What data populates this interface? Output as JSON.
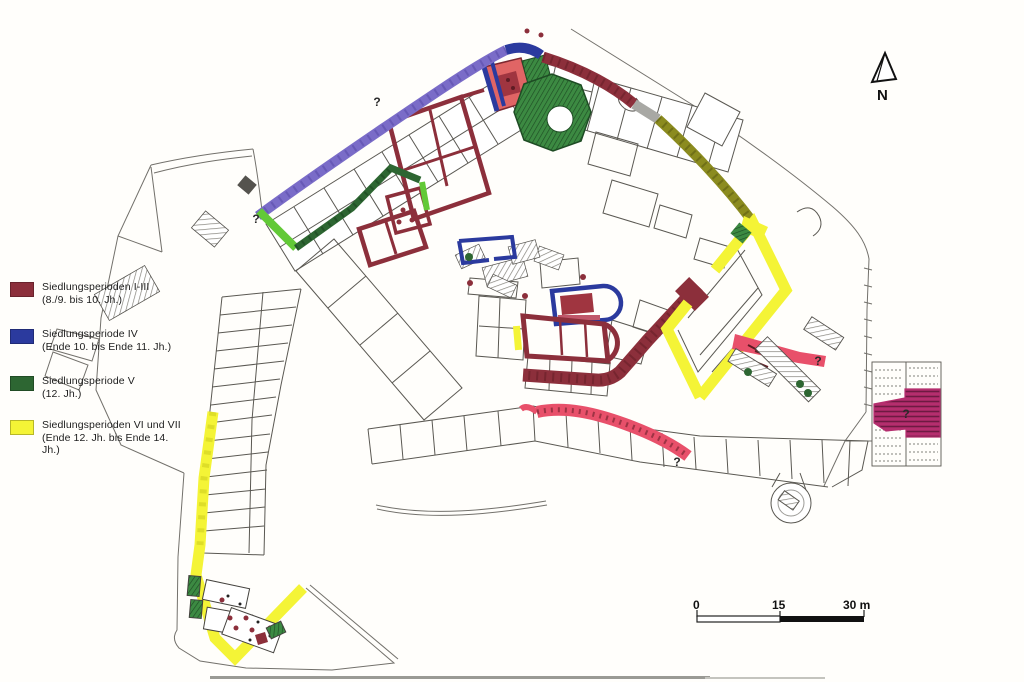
{
  "legend": {
    "items": [
      {
        "label": "Siedlungsperioden I-III",
        "sublabel": "(8./9. bis 10. Jh.)",
        "color": "#8c2f3b"
      },
      {
        "label": "Siedlungsperiode IV",
        "sublabel": "(Ende 10. bis Ende 11. Jh.)",
        "color": "#2b3a9e"
      },
      {
        "label": "Siedlungsperiode V",
        "sublabel": "(12. Jh.)",
        "color": "#2d6632"
      },
      {
        "label": "Siedlungsperioden VI und VII",
        "sublabel": "(Ende 12. Jh. bis Ende 14. Jh.)",
        "color": "#f4f436"
      }
    ]
  },
  "north_arrow": {
    "label": "N"
  },
  "scale_bar": {
    "labels": [
      "0",
      "15",
      "30 m"
    ]
  },
  "map": {
    "question_marks": [
      {
        "label": "?"
      },
      {
        "label": "?"
      },
      {
        "label": "?"
      },
      {
        "label": "?"
      },
      {
        "label": "?"
      }
    ],
    "colors": {
      "period_1_3": "#8c2f3b",
      "period_1_3_dark": "#5f1c24",
      "period_4": "#2b3a9e",
      "period_4_light": "#7a6cc8",
      "period_5": "#2d6632",
      "period_5_light": "#62c937",
      "period_6_7": "#f4f436",
      "olive_wall": "#8b8b1f",
      "pink_wall": "#e8506a",
      "magenta_area": "#b52e6e",
      "gray_wall": "#5a5852"
    }
  }
}
